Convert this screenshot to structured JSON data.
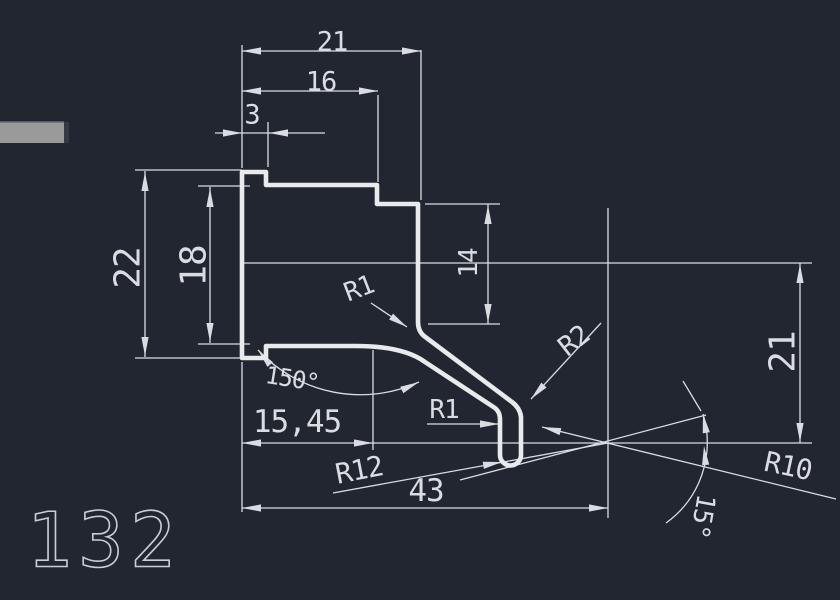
{
  "colors": {
    "background": "#212631",
    "profile_line": "#e8eaec",
    "dimension_line": "#d9dde2",
    "text": "#d9dde2",
    "gray_bar": "#9a9a9a",
    "sheet_text": "#c9ced4"
  },
  "labels": {
    "dim_width_total": "21",
    "dim_width_step": "16",
    "dim_width_tab": "3",
    "dim_height_flange": "22",
    "dim_height_inner": "18",
    "dim_height_face": "14",
    "dim_height_drop": "21",
    "dim_angle_bend": "150°",
    "dim_length_horiz": "15,45",
    "dim_length_total": "43",
    "dim_radius_bend_upper": "R1",
    "dim_radius_bend_lower": "R1",
    "dim_radius_outer": "R2",
    "dim_radius_sweep": "R12",
    "dim_radius_exit": "R10",
    "dim_angle_exit": "15°"
  },
  "sheet": {
    "number": "132"
  }
}
